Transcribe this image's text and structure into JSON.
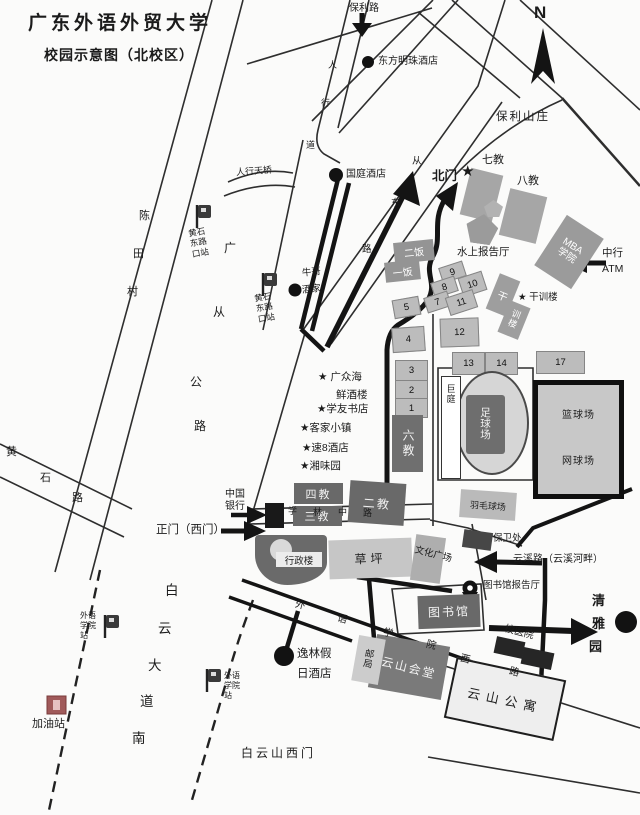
{
  "header": {
    "title": "广东外语外贸大学",
    "subtitle": "校园示意图（北校区）"
  },
  "compass_label": "N",
  "colors": {
    "route": "#141414",
    "building_dark": "#696969",
    "building_mid": "#9b9b9b",
    "building_light": "#bcbcbc",
    "gas_icon": "#a05a5a"
  },
  "roads": {
    "baoli": "保利路",
    "guangcong_chars": [
      "广",
      "从",
      "公",
      "路"
    ],
    "huangshi_chars": [
      "黄",
      "石",
      "路"
    ],
    "ne_road_chars": [
      "从",
      "东",
      "路"
    ],
    "walkway_chars": [
      "人",
      "行",
      "道"
    ],
    "footbridge": "人行天桥",
    "baiyun_ave_chars": [
      "白",
      "云",
      "大",
      "道",
      "南"
    ],
    "xuelin_chars": [
      "学",
      "林",
      "中",
      "路"
    ],
    "wy_west_chars": [
      "外",
      "语",
      "学",
      "院",
      "西",
      "路"
    ],
    "yunxi": "云溪路（云溪河畔）",
    "baiyunshan_gate": "白云山西门"
  },
  "gates": {
    "north": "北门",
    "north_star": "★",
    "main": "正门（西门）"
  },
  "bus_stops": {
    "huangshi_rows": [
      "黄石",
      "东路",
      "口站"
    ],
    "waiyu_rows": [
      "外语",
      "学院",
      "站"
    ]
  },
  "off_campus": {
    "chentian_chars": [
      "陈",
      "田",
      "村"
    ],
    "dongfang_hotel": "东方明珠酒店",
    "baoli_villa": "保利山庄",
    "guoting_hotel": "国庭酒店",
    "niuge_line1": "牛哥",
    "niuge_line2": "酒家",
    "yilin_line1": "逸林假",
    "yilin_line2": "日酒店",
    "qingya_chars": [
      "清",
      "雅",
      "园"
    ],
    "gas_station": "加油站",
    "star1a": "★ 广众海",
    "star1b": "鲜酒楼",
    "star2": "★学友书店",
    "star3": "★客家小镇",
    "star4": "★速8酒店",
    "star5": "★湘味园"
  },
  "buildings": {
    "b7": "七教",
    "b8": "八教",
    "b6": "六教",
    "b4": "四教",
    "b3": "三教",
    "b2": "二教",
    "mba1": "MBA",
    "mba2": "学院",
    "water_hall": "水上报告厅",
    "ganxun_star": "★ 干训楼",
    "ganxun_chars": [
      "干",
      "训",
      "楼"
    ],
    "canteen2": "二饭",
    "canteen1": "一饭",
    "nums": [
      "1",
      "2",
      "3",
      "4",
      "5",
      "7",
      "8",
      "9",
      "10",
      "11",
      "12",
      "13",
      "14",
      "17"
    ],
    "admin": "行政楼",
    "lawn": "草坪",
    "culture": "文化广场",
    "security": "保卫处",
    "badminton": "羽毛球场",
    "basketball": "篮球场",
    "tennis": "网球场",
    "football_chars": [
      "足",
      "球",
      "场"
    ],
    "stand_chars": [
      "巨",
      "庭"
    ],
    "library": "图书馆",
    "library_hall": "图书馆报告厅",
    "yunshan_hall": "云山会堂",
    "post_chars": [
      "邮",
      "局"
    ],
    "yunshan_apt": "云山公寓",
    "clinic": "校医院",
    "boc1": "中国",
    "boc2": "银行",
    "atm1": "中行",
    "atm2": "ATM"
  }
}
